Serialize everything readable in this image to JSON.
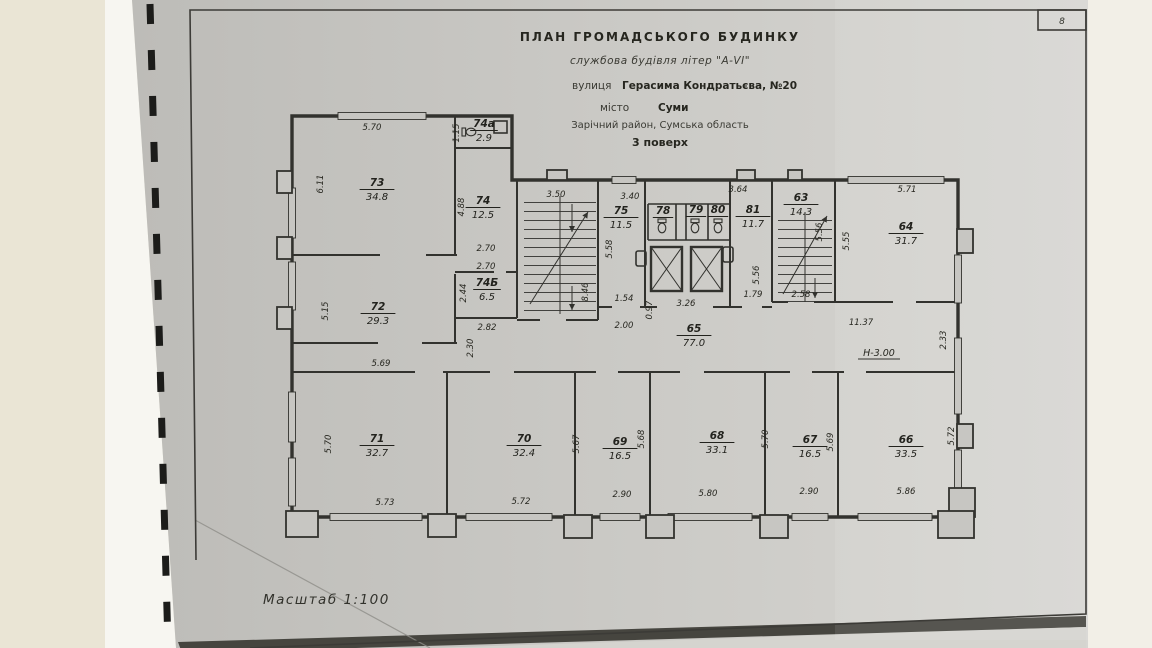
{
  "photo": {
    "background_color": "#eae5d5",
    "paper_color": "#c7c6c2",
    "line_color": "#32322e",
    "sheet_corner_label": "8"
  },
  "title_block": {
    "line1": "ПЛАН  ГРОМАДСЬКОГО  БУДИНКУ",
    "line2": "службова будівля літер \"А-VI\"",
    "line3_prefix": "вулиця",
    "line3_value": "Герасима Кондратьєва, №20",
    "line4_prefix": "місто",
    "line4_value": "Суми",
    "line5": "Зарічний район, Сумська область",
    "line6": "3 поверх"
  },
  "scale_label": "Масштаб   1:100",
  "plan": {
    "height_label": "Н-3.00",
    "rooms": [
      {
        "number": "73",
        "area": "34.8",
        "x": 377,
        "y": 186
      },
      {
        "number": "74а",
        "area": "2.9",
        "x": 484,
        "y": 127
      },
      {
        "number": "74",
        "area": "12.5",
        "x": 483,
        "y": 204
      },
      {
        "number": "74Б",
        "area": "6.5",
        "x": 487,
        "y": 286
      },
      {
        "number": "72",
        "area": "29.3",
        "x": 378,
        "y": 310
      },
      {
        "number": "75",
        "area": "11.5",
        "x": 621,
        "y": 214
      },
      {
        "number": "78",
        "area": "",
        "x": 663,
        "y": 214
      },
      {
        "number": "79",
        "area": "",
        "x": 696,
        "y": 213
      },
      {
        "number": "80",
        "area": "",
        "x": 718,
        "y": 213
      },
      {
        "number": "81",
        "area": "11.7",
        "x": 753,
        "y": 213
      },
      {
        "number": "63",
        "area": "14.3",
        "x": 801,
        "y": 201
      },
      {
        "number": "64",
        "area": "31.7",
        "x": 906,
        "y": 230
      },
      {
        "number": "65",
        "area": "77.0",
        "x": 694,
        "y": 332
      },
      {
        "number": "71",
        "area": "32.7",
        "x": 377,
        "y": 442
      },
      {
        "number": "70",
        "area": "32.4",
        "x": 524,
        "y": 442
      },
      {
        "number": "69",
        "area": "16.5",
        "x": 620,
        "y": 445
      },
      {
        "number": "68",
        "area": "33.1",
        "x": 717,
        "y": 439
      },
      {
        "number": "67",
        "area": "16.5",
        "x": 810,
        "y": 443
      },
      {
        "number": "66",
        "area": "33.5",
        "x": 906,
        "y": 443
      }
    ],
    "dims": [
      {
        "v": "5.70",
        "x": 372,
        "y": 130,
        "r": 0
      },
      {
        "v": "1.15",
        "x": 459,
        "y": 133,
        "r": -90
      },
      {
        "v": "6.11",
        "x": 323,
        "y": 184,
        "r": -90
      },
      {
        "v": "4.88",
        "x": 464,
        "y": 207,
        "r": -90
      },
      {
        "v": "2.70",
        "x": 486,
        "y": 251,
        "r": 0
      },
      {
        "v": "2.70",
        "x": 486,
        "y": 269,
        "r": 0
      },
      {
        "v": "2.44",
        "x": 466,
        "y": 293,
        "r": -90
      },
      {
        "v": "5.15",
        "x": 328,
        "y": 311,
        "r": -90
      },
      {
        "v": "2.82",
        "x": 487,
        "y": 330,
        "r": 0
      },
      {
        "v": "2.30",
        "x": 473,
        "y": 348,
        "r": -90
      },
      {
        "v": "3.50",
        "x": 556,
        "y": 197,
        "r": 0
      },
      {
        "v": "3.40",
        "x": 630,
        "y": 199,
        "r": 0
      },
      {
        "v": "5.58",
        "x": 612,
        "y": 249,
        "r": -90
      },
      {
        "v": "8.46",
        "x": 588,
        "y": 292,
        "r": -90
      },
      {
        "v": "3.64",
        "x": 738,
        "y": 192,
        "r": 0
      },
      {
        "v": "5.56",
        "x": 822,
        "y": 232,
        "r": -90
      },
      {
        "v": "5.55",
        "x": 849,
        "y": 241,
        "r": -90
      },
      {
        "v": "5.71",
        "x": 907,
        "y": 192,
        "r": 0
      },
      {
        "v": "1.54",
        "x": 624,
        "y": 301,
        "r": 0
      },
      {
        "v": "0.97",
        "x": 652,
        "y": 310,
        "r": -90
      },
      {
        "v": "3.26",
        "x": 686,
        "y": 306,
        "r": 0
      },
      {
        "v": "5.56",
        "x": 759,
        "y": 275,
        "r": -90
      },
      {
        "v": "1.79",
        "x": 753,
        "y": 297,
        "r": 0
      },
      {
        "v": "2.58",
        "x": 801,
        "y": 297,
        "r": 0
      },
      {
        "v": "2.00",
        "x": 624,
        "y": 328,
        "r": 0
      },
      {
        "v": "11.37",
        "x": 861,
        "y": 325,
        "r": 0
      },
      {
        "v": "2.33",
        "x": 946,
        "y": 340,
        "r": -90
      },
      {
        "v": "5.69",
        "x": 381,
        "y": 366,
        "r": 0
      },
      {
        "v": "5.70",
        "x": 331,
        "y": 444,
        "r": -90
      },
      {
        "v": "5.67",
        "x": 579,
        "y": 444,
        "r": -90
      },
      {
        "v": "5.68",
        "x": 644,
        "y": 439,
        "r": -90
      },
      {
        "v": "5.70",
        "x": 768,
        "y": 439,
        "r": -90
      },
      {
        "v": "5.69",
        "x": 833,
        "y": 442,
        "r": -90
      },
      {
        "v": "5.72",
        "x": 954,
        "y": 436,
        "r": -90
      },
      {
        "v": "5.73",
        "x": 385,
        "y": 505,
        "r": 0
      },
      {
        "v": "5.72",
        "x": 521,
        "y": 504,
        "r": 0
      },
      {
        "v": "2.90",
        "x": 622,
        "y": 497,
        "r": 0
      },
      {
        "v": "5.80",
        "x": 708,
        "y": 496,
        "r": 0
      },
      {
        "v": "2.90",
        "x": 809,
        "y": 494,
        "r": 0
      },
      {
        "v": "5.86",
        "x": 906,
        "y": 494,
        "r": 0
      }
    ]
  }
}
